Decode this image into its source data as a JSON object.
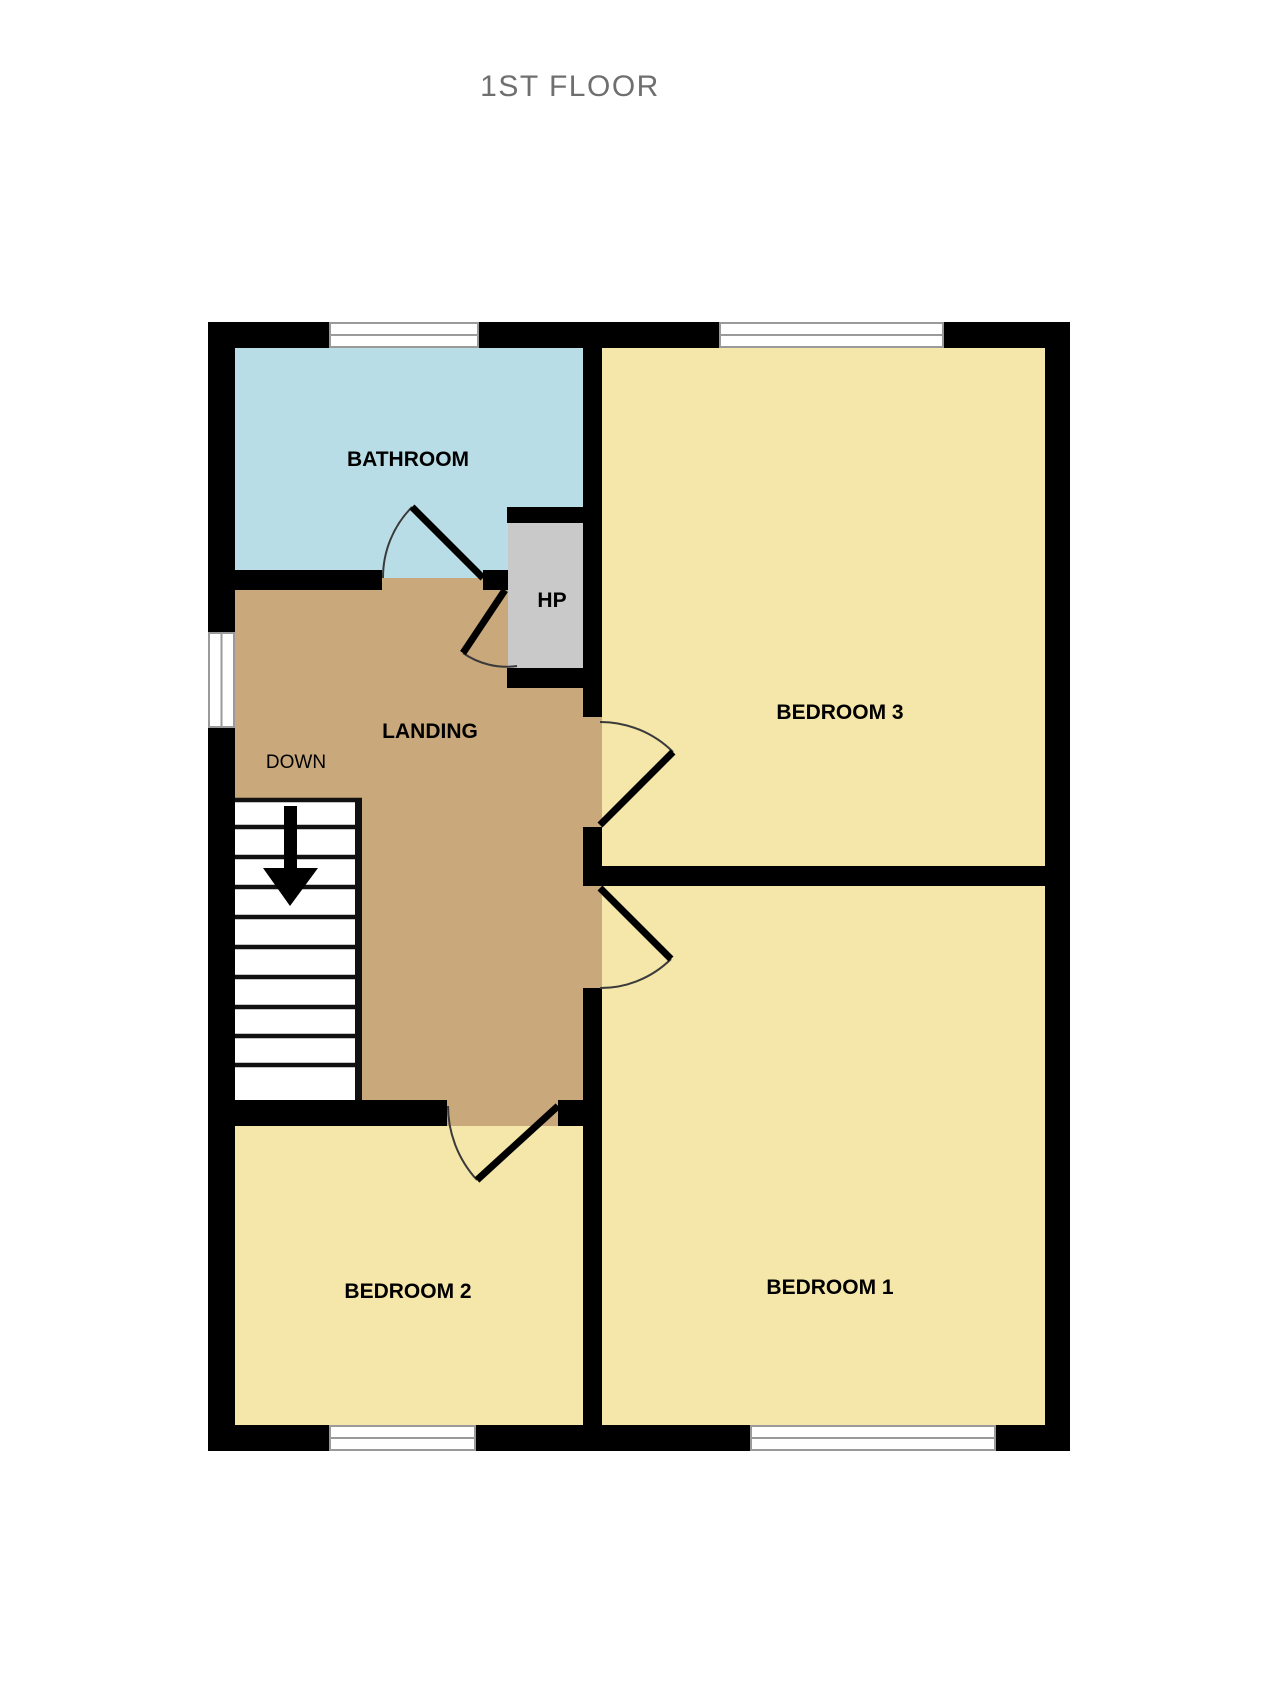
{
  "title": "1ST FLOOR",
  "colors": {
    "bathroom": "#b9dde6",
    "landing": "#c9a87c",
    "bedroom": "#f5e6a9",
    "closet": "#c9c9c9",
    "wall": "#000000",
    "window_frame": "#9a9a9a",
    "door_arc": "#3a3a3a",
    "label": "#000000",
    "title_color": "#6f6f6f",
    "background": "#ffffff"
  },
  "labels": {
    "bathroom": "BATHROOM",
    "hp": "HP",
    "landing": "LANDING",
    "down": "DOWN",
    "bedroom3": "BEDROOM 3",
    "bedroom2": "BEDROOM 2",
    "bedroom1": "BEDROOM 1"
  }
}
